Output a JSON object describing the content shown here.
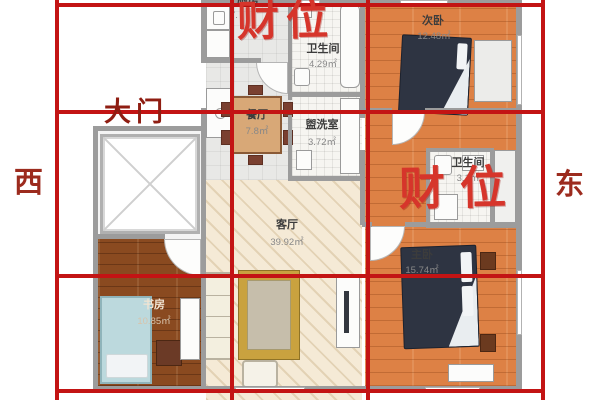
{
  "compass": {
    "west": "西",
    "east": "东"
  },
  "markers": {
    "wealth_top": "财位",
    "wealth_right": "财位",
    "main_door": "大门"
  },
  "rooms": {
    "kitchen": {
      "name": "厨房",
      "area": "7."
    },
    "bath_top": {
      "name": "卫生间",
      "area": "4.29㎡"
    },
    "bedroom2": {
      "name": "次卧",
      "area": "12.48㎡"
    },
    "dining": {
      "name": "餐厅",
      "area": "7.8㎡"
    },
    "washroom": {
      "name": "盥洗室",
      "area": "3.72㎡"
    },
    "bath_right": {
      "name": "卫生间",
      "area": "3.1㎡"
    },
    "living": {
      "name": "客厅",
      "area": "39.92㎡"
    },
    "study": {
      "name": "书房",
      "area": "10.85㎡"
    },
    "master": {
      "name": "主卧",
      "area": "15.74㎡"
    }
  },
  "colors": {
    "grid_red": "#c31414",
    "wealth_red": "#d6352b",
    "door_label_red": "#8f1d12",
    "wall_gray": "#9c9c9c",
    "wood_orange": "#dd8145",
    "wood_brown": "#8a4a20",
    "living_cream": "#f5ead6",
    "bed_navy": "#2e3442"
  }
}
